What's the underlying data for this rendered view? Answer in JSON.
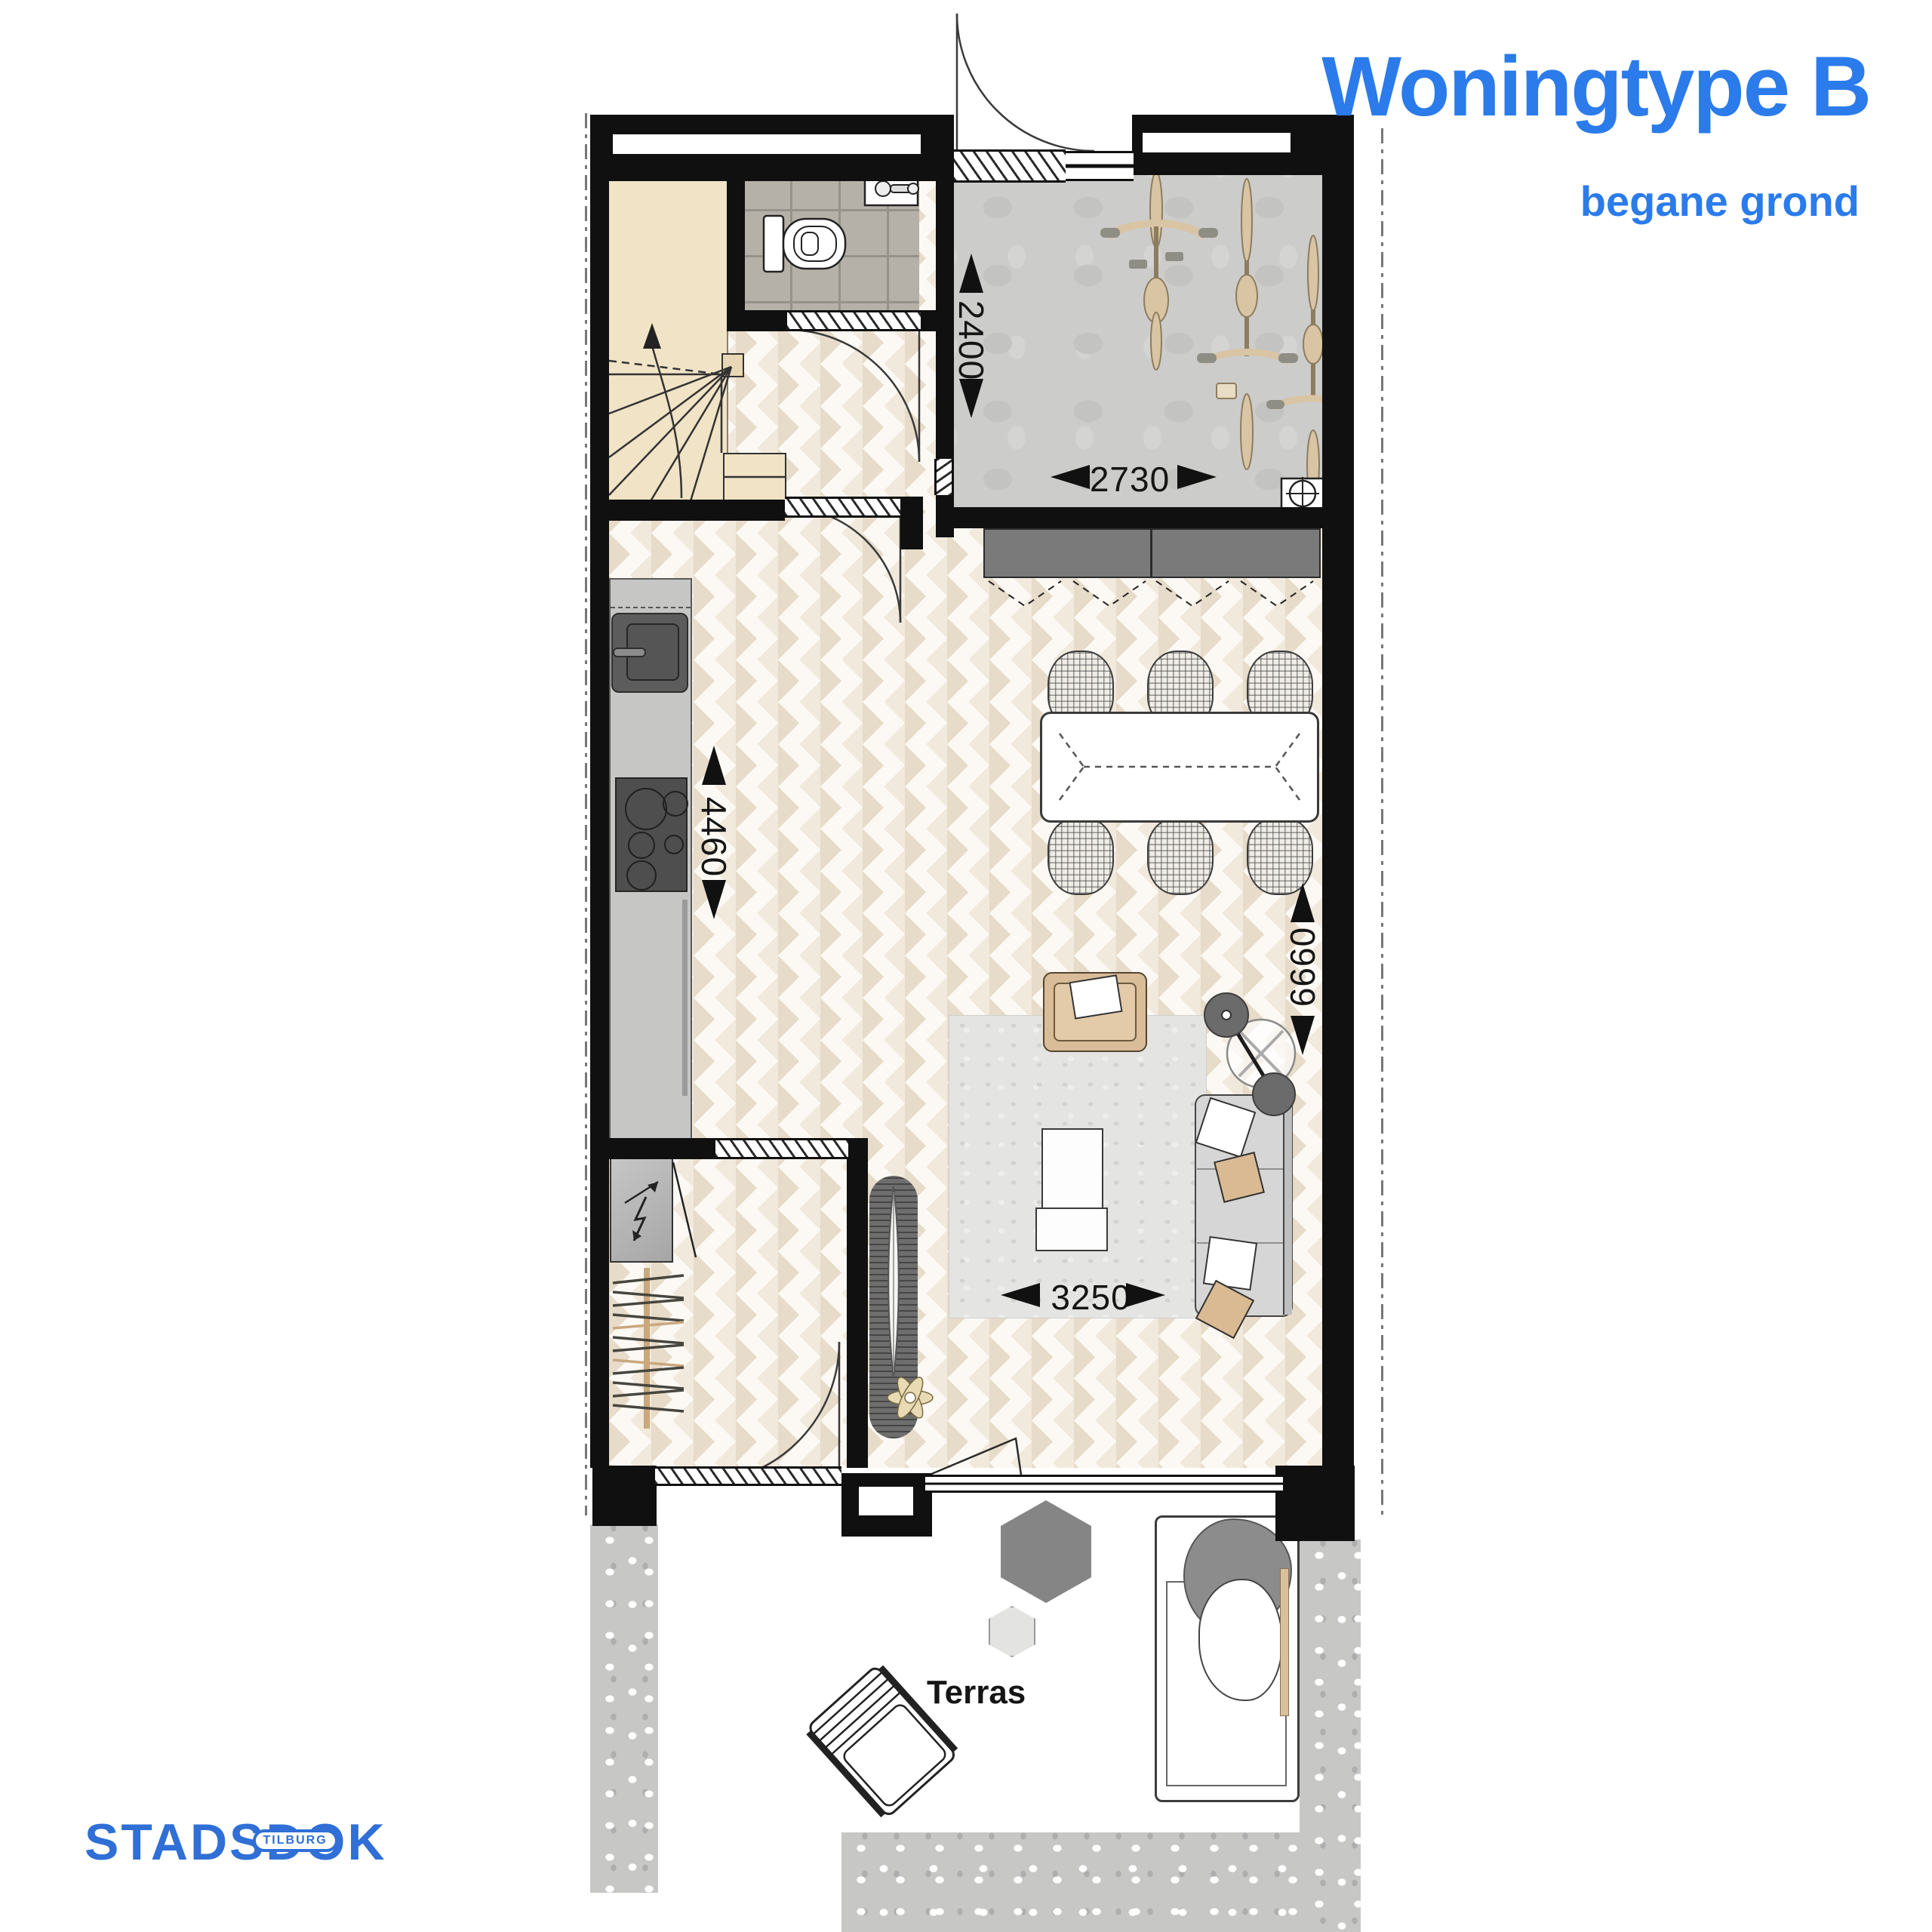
{
  "header": {
    "title": "Woningtype B",
    "subtitle": "begane grond"
  },
  "plan": {
    "terrace_label": "Terras",
    "dimensions": {
      "bike_storage_depth": "2400",
      "bike_storage_width": "2730",
      "kitchen_wall_length": "4460",
      "living_room_depth": "6660",
      "living_room_width": "3250"
    }
  },
  "footer_logo": {
    "prefix": "STADSD",
    "o": "O",
    "suffix": "K",
    "badge": "TILBURG"
  },
  "colors": {
    "accent_blue": "#2B7BEB",
    "logo_blue": "#2F6FD6",
    "wall_black": "#101010",
    "chevron_beige": "#E7DBC9",
    "stair_beige": "#F1E3C6",
    "tile_gray": "#B6B1A8",
    "concrete_gray": "#CCCCCB",
    "cabinet_gray": "#7A7A7A",
    "tan_furniture": "#D9BC98",
    "gravel_gray": "#C7C7C6"
  }
}
